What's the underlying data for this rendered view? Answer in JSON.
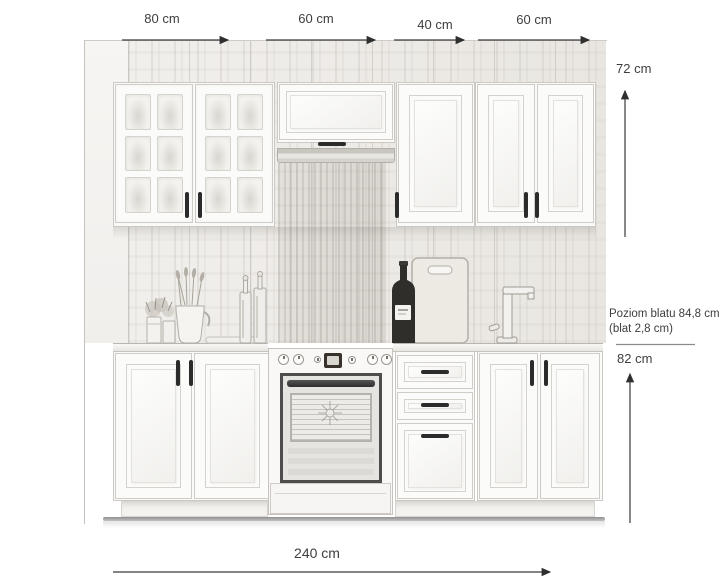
{
  "diagram": {
    "top_widths": [
      {
        "label": "80 cm"
      },
      {
        "label": "60 cm"
      },
      {
        "label": "40 cm"
      },
      {
        "label": "60 cm"
      }
    ],
    "upper_height_label": "72 cm",
    "worktop_note_line1": "Poziom blatu 84,8 cm",
    "worktop_note_line2": "(blat 2,8 cm)",
    "base_height_label": "82 cm",
    "total_width_label": "240 cm"
  },
  "measurements": {
    "upper_cabinet_widths_cm": [
      80,
      60,
      40,
      60
    ],
    "upper_cabinet_height_cm": 72,
    "base_cabinet_height_cm": 82,
    "worktop_level_cm": "84,8",
    "worktop_thickness_cm": "2,8",
    "total_width_cm": 240
  },
  "colors": {
    "background": "#ffffff",
    "wall_wood": "#efede9",
    "cabinet_white": "#fbfbfa",
    "outline_gray": "#c9c6c1",
    "handle_dark": "#2b2b2b",
    "oven_frame": "#4d4d4d",
    "dimension_text": "#3e3e3e",
    "dimension_line": "#3a3a3a"
  }
}
